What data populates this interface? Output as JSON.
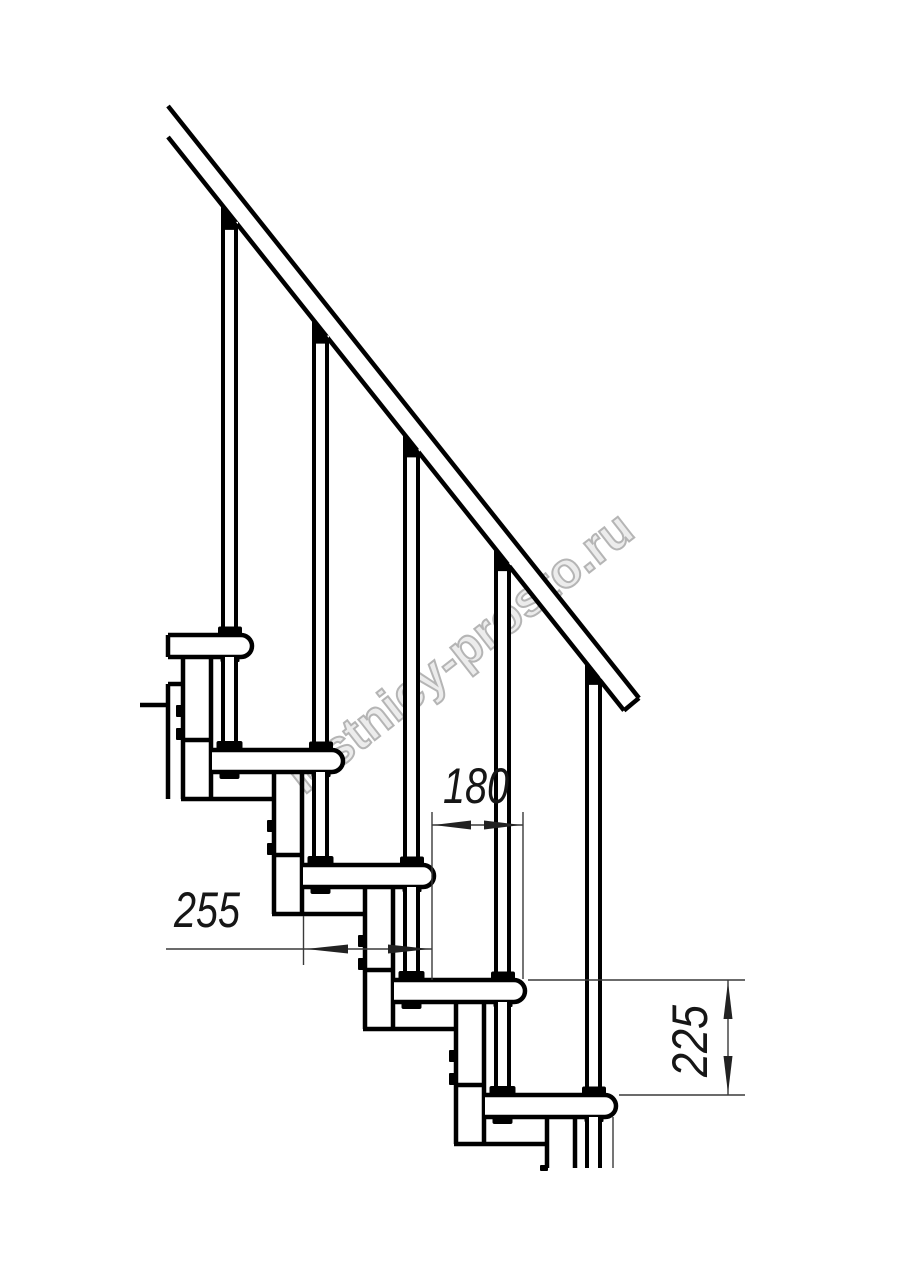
{
  "page": {
    "background": "#ffffff",
    "width": 914,
    "height": 1280
  },
  "watermark": {
    "text": "lestnicy-prosto.ru",
    "color": "#b5b5b5",
    "angle_deg": -38
  },
  "drawing": {
    "description": "Side elevation of a modular staircase: sloped handrail, five balusters, five treads on stacked support modules with bolted brackets",
    "line_color": "#000000",
    "dim_color": "#3a3a3a",
    "text_color": "#161616",
    "modules_visible": 5,
    "handrail": true
  },
  "dimensions": [
    {
      "id": "tread-depth",
      "label": "255",
      "orientation": "horizontal"
    },
    {
      "id": "step-run",
      "label": "180",
      "orientation": "horizontal"
    },
    {
      "id": "step-rise",
      "label": "225",
      "orientation": "vertical"
    }
  ]
}
